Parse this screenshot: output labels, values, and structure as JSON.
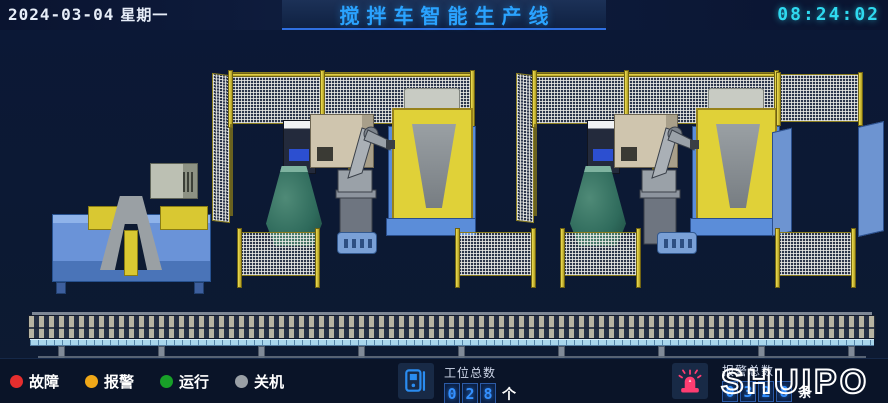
{
  "header": {
    "date": "2024-03-04",
    "weekday": "星期一",
    "title": "搅拌车智能生产线",
    "time": "08:24:02"
  },
  "legend": {
    "items": [
      {
        "label": "故障",
        "color": "#e62e2e"
      },
      {
        "label": "报警",
        "color": "#f0a818"
      },
      {
        "label": "运行",
        "color": "#18a028"
      },
      {
        "label": "关机",
        "color": "#9aa0a6"
      }
    ]
  },
  "station_counter": {
    "label": "工位总数",
    "digits": [
      "0",
      "2",
      "8"
    ],
    "unit": "个"
  },
  "alarm_counter": {
    "label": "报警总数",
    "digits": [
      "0",
      "3",
      "2",
      "8"
    ],
    "unit": "条"
  },
  "logo": {
    "text": "SHUIPO"
  },
  "colors": {
    "title_blue": "#2aa3ff",
    "time_cyan": "#2fd9ef",
    "digit_blue": "#3490ff",
    "siren_pink": "#ff3d71",
    "device_blue": "#2a8cf0"
  }
}
